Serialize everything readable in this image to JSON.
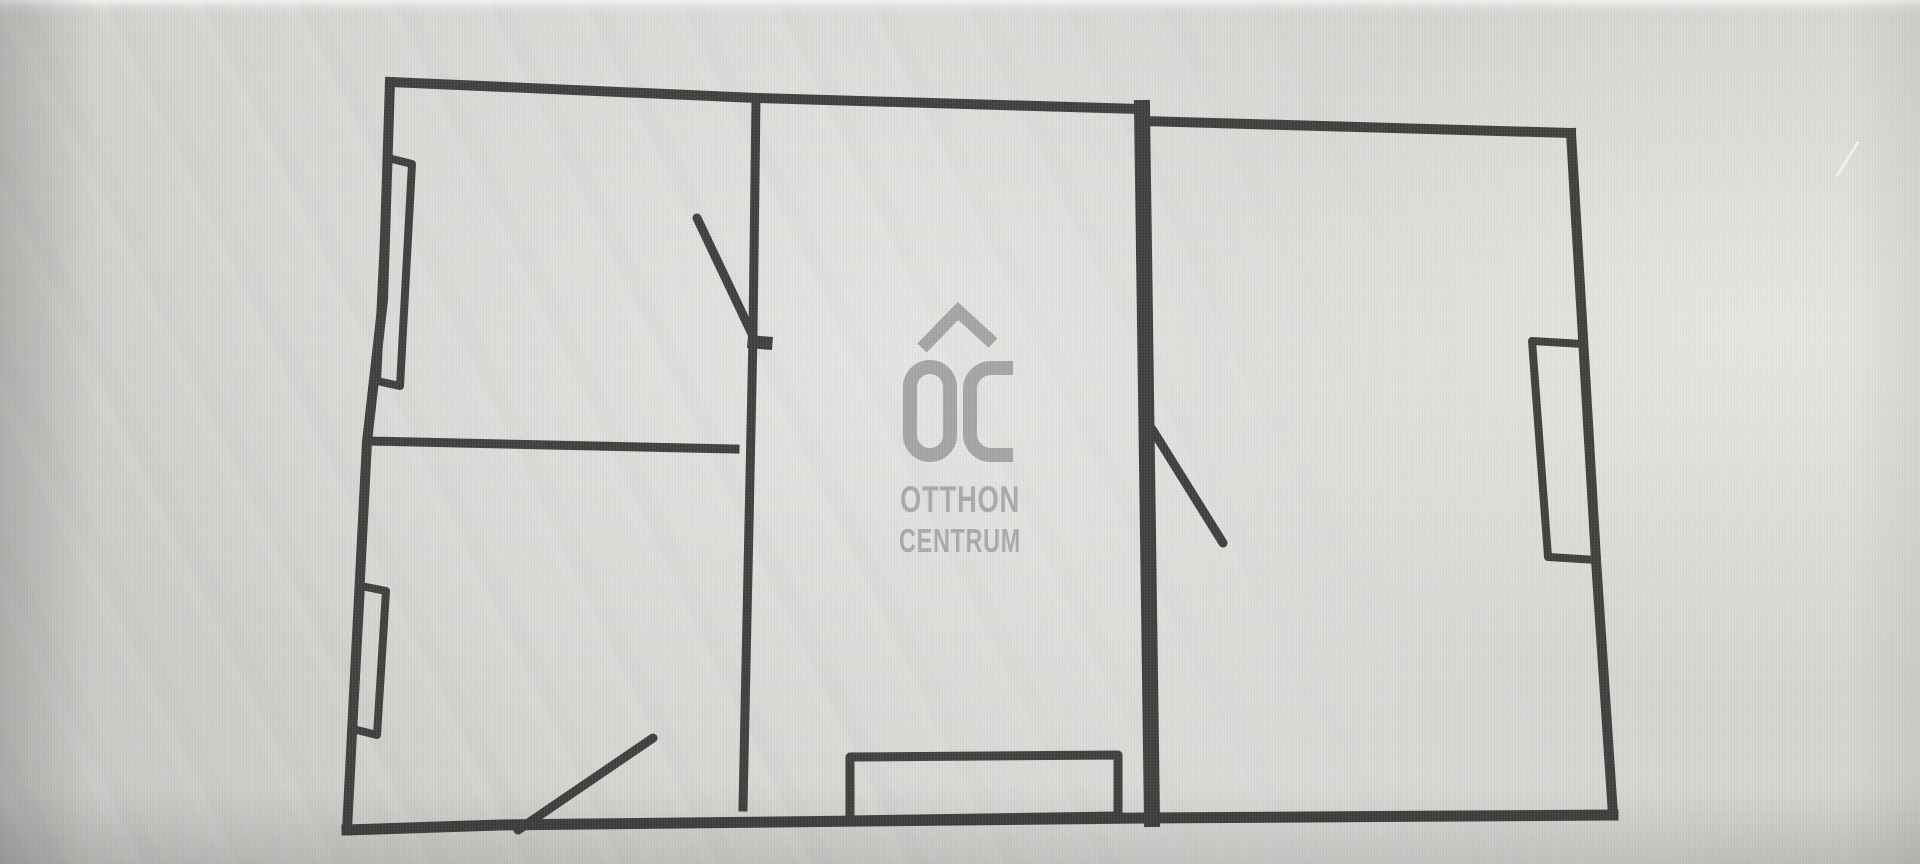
{
  "logo": {
    "monogram": "OC",
    "line1": "OTTHON",
    "line2": "CENTRUM"
  },
  "colors": {
    "background": "#d6d5d2",
    "wall": "#3b3a38",
    "logo": "#9e9e9e",
    "logo_text": "#a4a4a4"
  },
  "floor_plan": {
    "stroke_color": "#3b3a38",
    "walls": [
      {
        "name": "exterior-wall-top-left",
        "points": [
          [
            390,
            82
          ],
          [
            757,
            98
          ],
          [
            1140,
            109
          ]
        ],
        "w": 10
      },
      {
        "name": "exterior-wall-top-right",
        "points": [
          [
            1143,
            121
          ],
          [
            1571,
            133
          ]
        ],
        "w": 10
      },
      {
        "name": "exterior-wall-right",
        "points": [
          [
            1571,
            133
          ],
          [
            1596,
            560
          ],
          [
            1613,
            815
          ]
        ],
        "w": 10
      },
      {
        "name": "exterior-wall-bottom",
        "points": [
          [
            1613,
            815
          ],
          [
            1145,
            818
          ],
          [
            500,
            825
          ],
          [
            347,
            830
          ]
        ],
        "w": 11
      },
      {
        "name": "exterior-wall-left",
        "points": [
          [
            390,
            82
          ],
          [
            383,
            300
          ],
          [
            367,
            442
          ],
          [
            347,
            830
          ]
        ],
        "w": 10
      },
      {
        "name": "interior-wall-vertical-thin",
        "points": [
          [
            756,
            98
          ],
          [
            753,
            335
          ],
          [
            743,
            807
          ]
        ],
        "w": 9
      },
      {
        "name": "interior-wall-horizontal-divider",
        "points": [
          [
            367,
            441
          ],
          [
            735,
            449
          ]
        ],
        "w": 9
      },
      {
        "name": "interior-wall-vertical-thick",
        "points": [
          [
            1142,
            108
          ],
          [
            1152,
            819
          ]
        ],
        "w": 16
      },
      {
        "name": "door-hinge-nub",
        "points": [
          [
            754,
            342
          ],
          [
            766,
            343
          ]
        ],
        "w": 13
      }
    ],
    "doors": [
      {
        "name": "door-swing-top-left-room",
        "points": [
          [
            697,
            218
          ],
          [
            752,
            334
          ]
        ],
        "w": 9
      },
      {
        "name": "door-swing-bottom-left-room",
        "points": [
          [
            518,
            830
          ],
          [
            653,
            738
          ]
        ],
        "w": 9
      },
      {
        "name": "door-swing-right-room",
        "points": [
          [
            1152,
            429
          ],
          [
            1223,
            543
          ]
        ],
        "w": 9
      }
    ],
    "windows": [
      {
        "name": "window-left-upper",
        "points": [
          [
            388,
            158
          ],
          [
            412,
            164
          ],
          [
            400,
            386
          ],
          [
            377,
            381
          ]
        ],
        "w": 8,
        "closed": true
      },
      {
        "name": "window-left-lower",
        "points": [
          [
            361,
            586
          ],
          [
            386,
            591
          ],
          [
            377,
            735
          ],
          [
            353,
            729
          ]
        ],
        "w": 8,
        "closed": true
      },
      {
        "name": "window-right",
        "points": [
          [
            1532,
            341
          ],
          [
            1583,
            344
          ],
          [
            1597,
            560
          ],
          [
            1548,
            557
          ]
        ],
        "w": 8,
        "closed": true
      },
      {
        "name": "window-bottom-french-door",
        "points": [
          [
            850,
            757
          ],
          [
            1118,
            755
          ],
          [
            1118,
            816
          ],
          [
            850,
            820
          ]
        ],
        "w": 9,
        "closed": true
      }
    ]
  }
}
